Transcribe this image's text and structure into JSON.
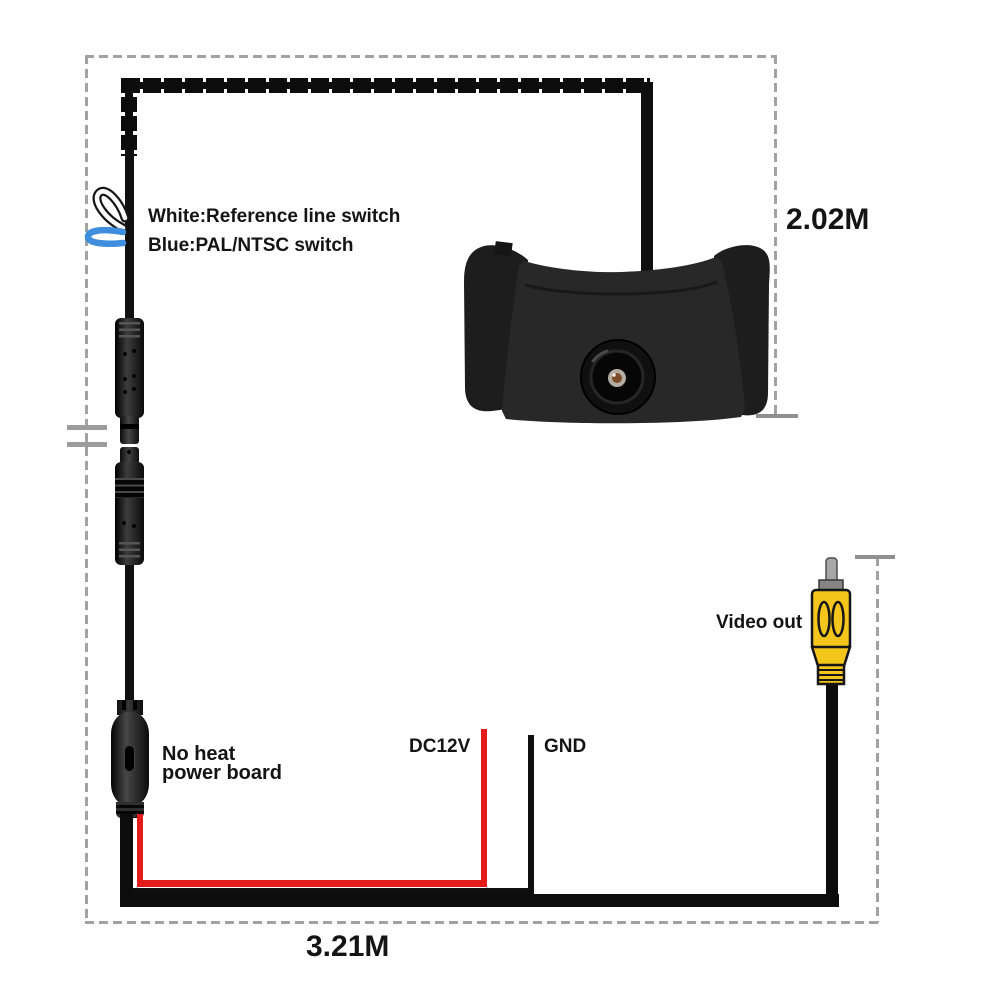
{
  "annotations": {
    "white_switch_label": "White:Reference line switch",
    "blue_switch_label": "Blue:PAL/NTSC switch",
    "vertical_cable_length": "2.02M",
    "horizontal_cable_length": "3.21M",
    "video_out_label": "Video out",
    "power_board_label_line1": "No heat",
    "power_board_label_line2": "power board",
    "power_wire_label": "DC12V",
    "ground_wire_label": "GND"
  },
  "colors": {
    "power_wire_red": "#e41a1b",
    "pal_ntsc_loop_blue": "#3f8ede",
    "reference_loop_white": "#ffffff",
    "rca_connector_yellow": "#f4c51a",
    "cable_black": "#0c0c0c",
    "measurement_dash_gray": "#a2a2a2"
  }
}
